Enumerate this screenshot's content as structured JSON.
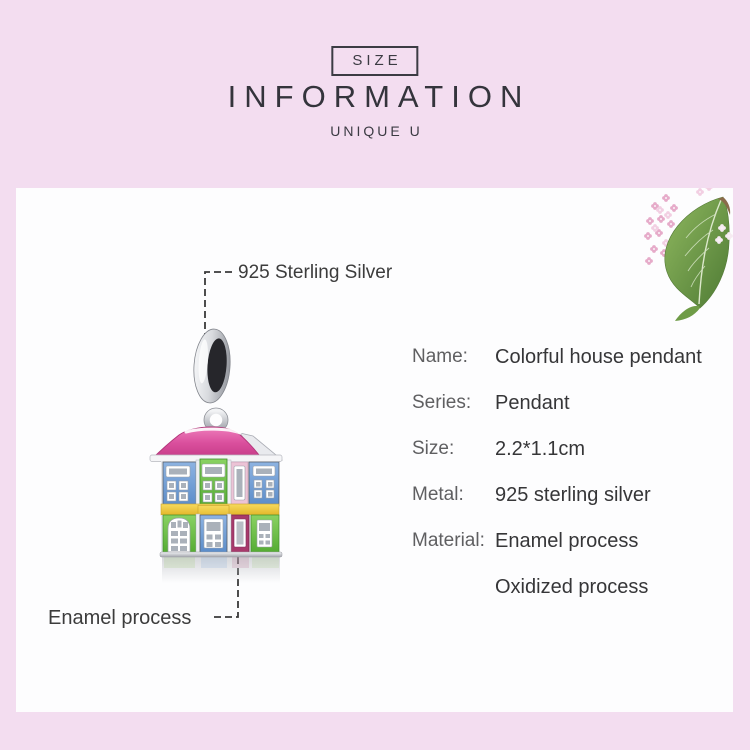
{
  "header": {
    "size_label": "SIZE",
    "title": "INFORMATION",
    "subtitle": "UNIQUE U"
  },
  "callouts": {
    "silver": "925 Sterling Silver",
    "enamel": "Enamel process"
  },
  "specs": {
    "rows": [
      {
        "label": "Name:",
        "value": "Colorful house pendant"
      },
      {
        "label": "Series:",
        "value": "Pendant"
      },
      {
        "label": "Size:",
        "value": "2.2*1.1cm"
      },
      {
        "label": "Metal:",
        "value": "925 sterling silver"
      },
      {
        "label": "Material:",
        "value": "Enamel process"
      },
      {
        "label": "",
        "value": "Oxidized process"
      }
    ]
  },
  "product": {
    "name": "Colorful house pendant",
    "illustration": "colorful-house-charm-with-silver-bail",
    "decoration": "lilac-flowers-and-leaf"
  },
  "colors": {
    "page_background": "#f3ddf0",
    "panel_background": "#fdfdfe",
    "title_text": "#34343c",
    "label_text": "#5f5f61",
    "value_text": "#363638",
    "roof_pink": "#da4f9d",
    "enamel_blue": "#6b9bd6",
    "enamel_green": "#6cc24a",
    "enamel_yellow": "#f0c93a",
    "enamel_magenta": "#a83a6c",
    "enamel_light_pink": "#ecc3d6",
    "silver": "#c9ccd3",
    "leaf_green": "#6f9c47",
    "lilac_pink": "#e6abc9"
  }
}
